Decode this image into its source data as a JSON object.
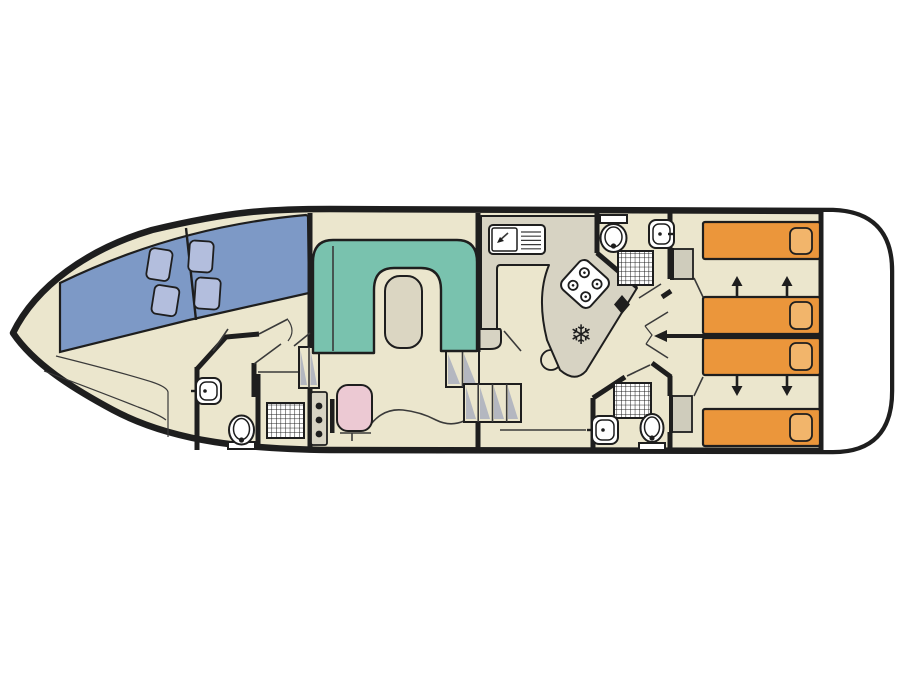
{
  "figure": {
    "type": "boat-deck-floor-plan",
    "orientation": "bow-left-stern-right",
    "background": "#ffffff"
  },
  "colors": {
    "outline": "#1e1e1e",
    "thin_line": "#3a3a3a",
    "floor": "#ebe6cd",
    "deck_white": "#ffffff",
    "windshield_blue": "#7d99c6",
    "pillow_blue": "#b3bedd",
    "sofa_teal": "#79c2ae",
    "table_beige": "#dbd6c2",
    "counter_gray": "#d7d3c3",
    "wardrobe_gray": "#cfccbc",
    "bed_orange": "#eb963b",
    "bed_pillow": "#f2b56b",
    "seat_pink": "#ecc9d3",
    "fixture_white": "#ffffff",
    "steps_shade": "#b4b7c0"
  },
  "icons": {
    "fridge_snowflake": "❄"
  },
  "legend": {
    "rooms": [
      "bow-cabin",
      "fore-wc",
      "fore-shower-room",
      "saloon",
      "galley",
      "aft-bathroom-port",
      "aft-bathroom-starboard",
      "aft-cabins",
      "stern-deck"
    ],
    "fixtures": [
      "windshield",
      "u-sofa",
      "dinette-table",
      "helm-console",
      "helm-seat",
      "galley-sink",
      "stove",
      "fridge",
      "toilet",
      "washbasin",
      "shower",
      "wardrobe",
      "stairs",
      "single-bed",
      "sliding-bed-arrow"
    ]
  }
}
